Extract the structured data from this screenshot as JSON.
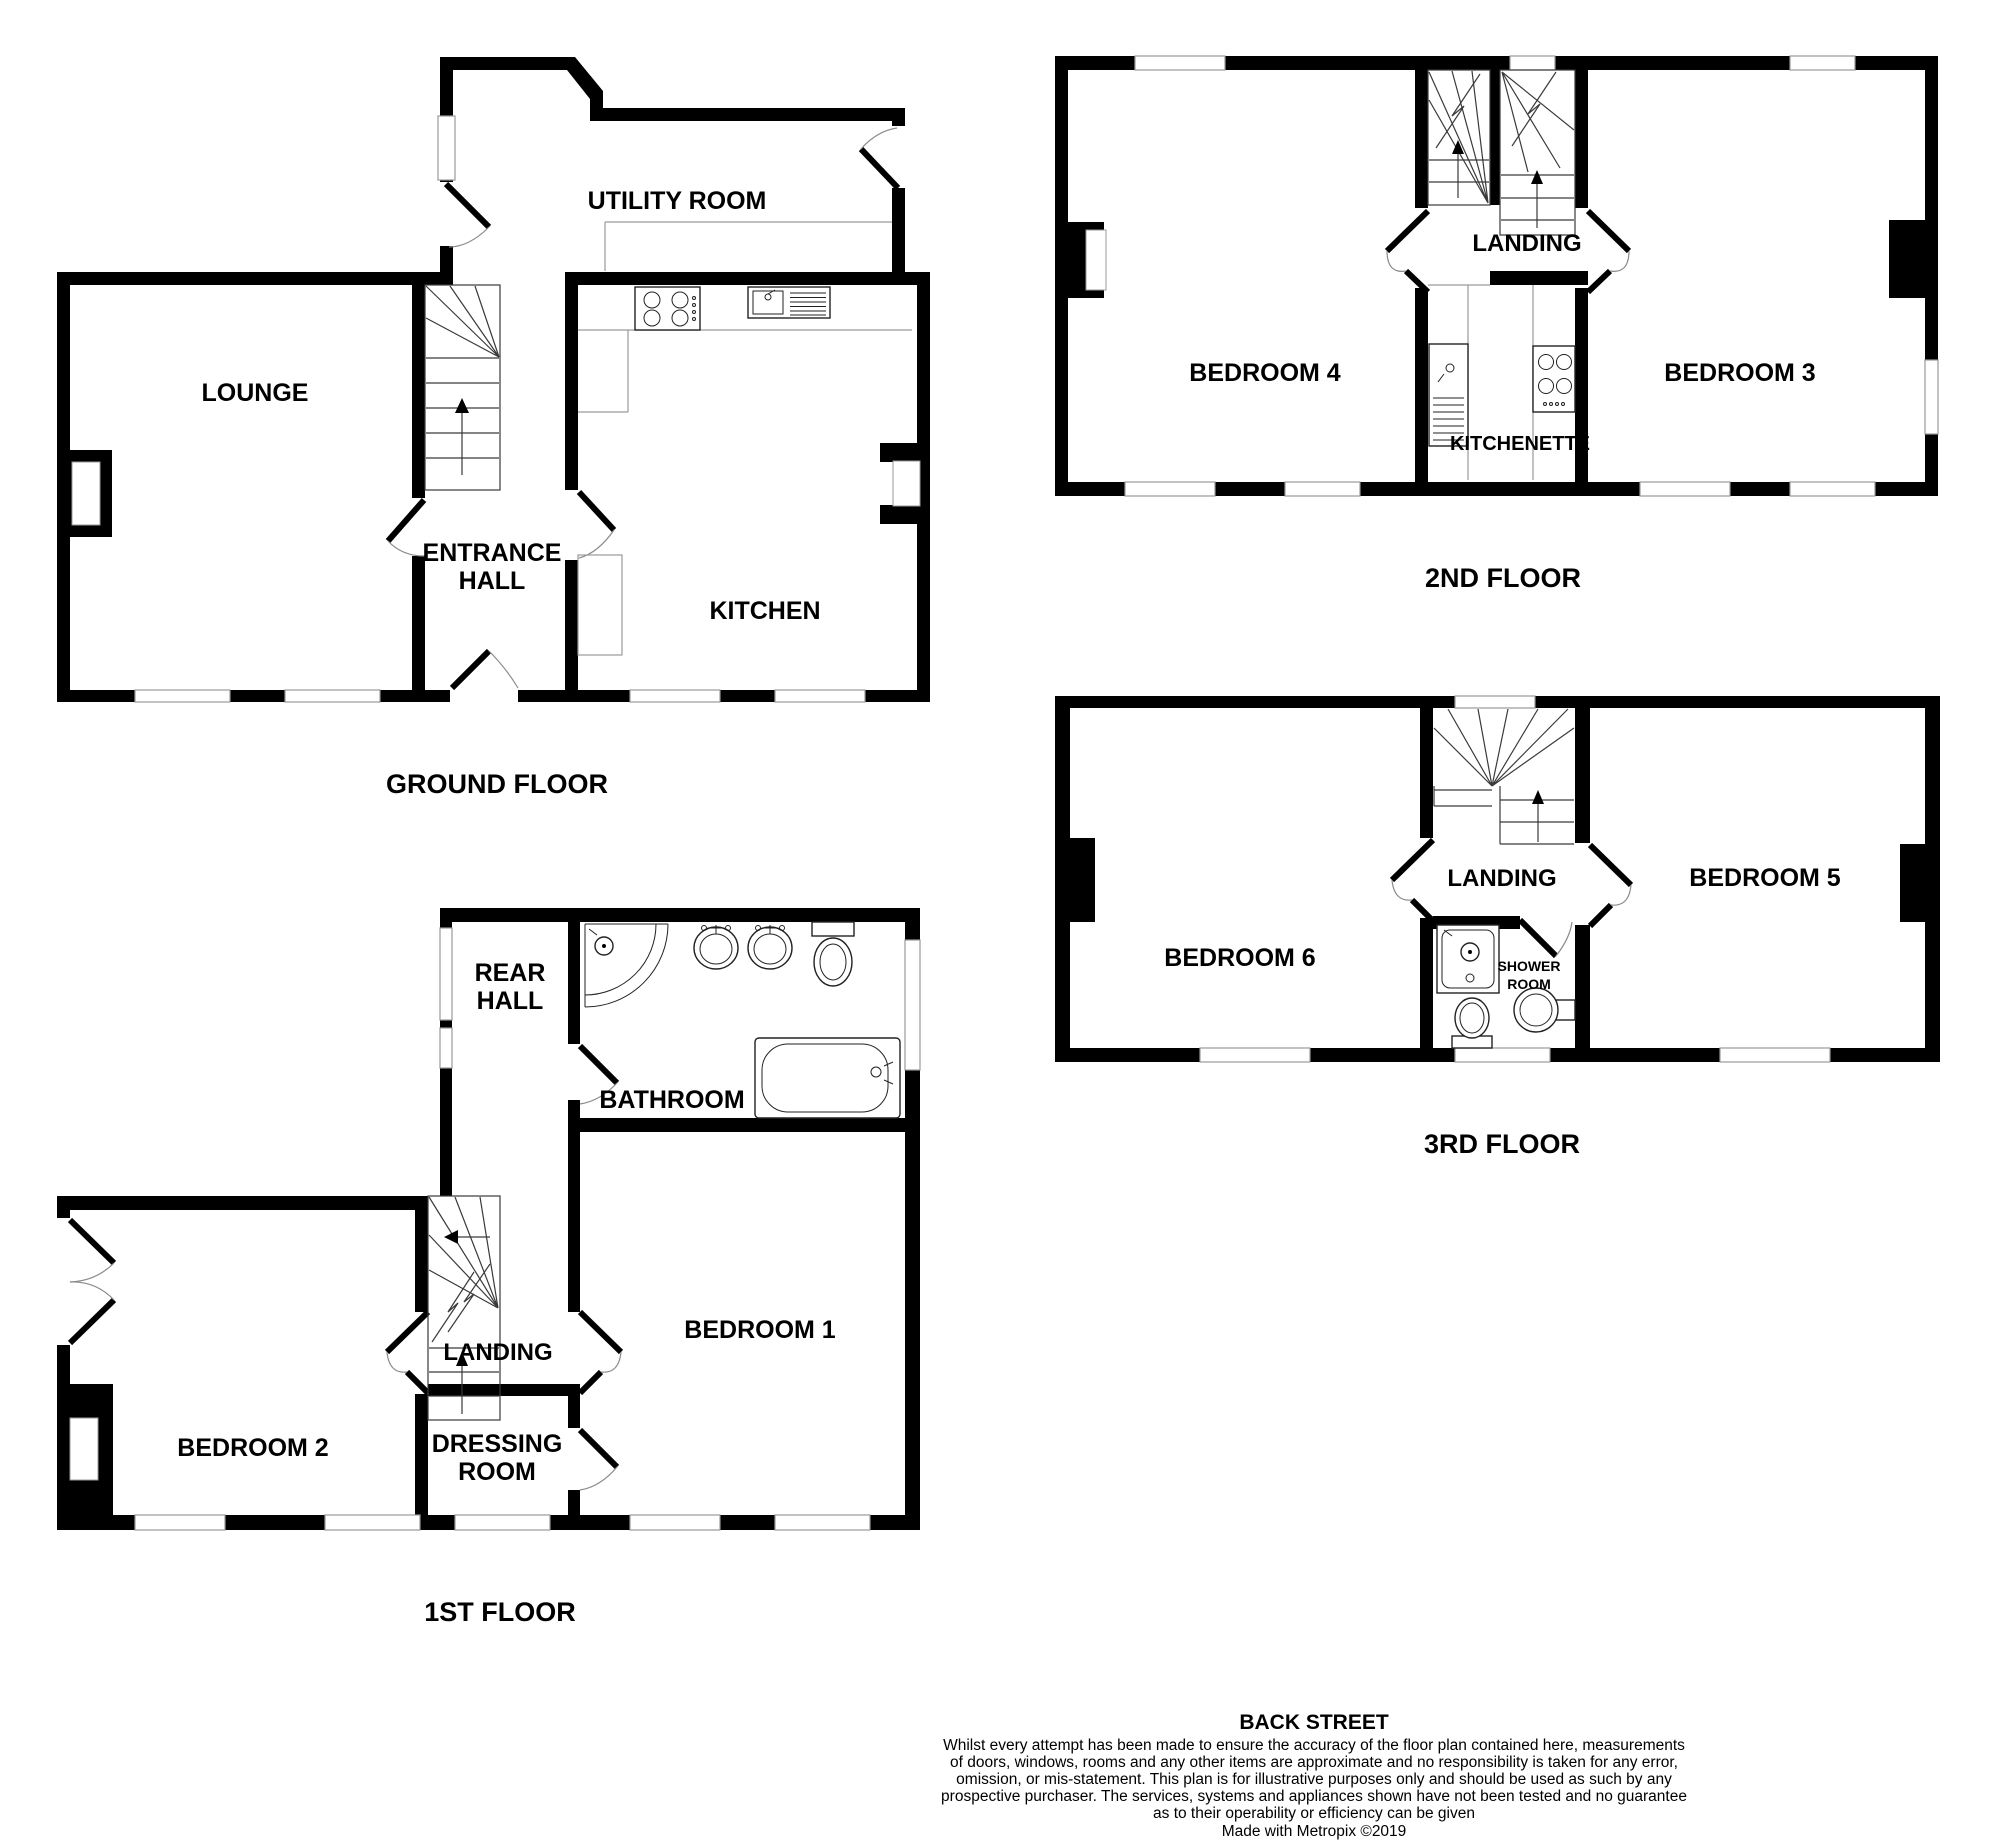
{
  "title": "BACK STREET",
  "colors": {
    "walls": "#000000",
    "thin_lines": "#9a9a9a",
    "stair_lines": "#3a3a3a",
    "background": "#ffffff",
    "text": "#000000"
  },
  "floors": {
    "ground": {
      "label": "GROUND FLOOR",
      "rooms": {
        "lounge": "LOUNGE",
        "entrance": [
          "ENTRANCE",
          "HALL"
        ],
        "kitchen": "KITCHEN",
        "utility": "UTILITY ROOM"
      }
    },
    "first": {
      "label": "1ST FLOOR",
      "rooms": {
        "rear_hall": [
          "REAR",
          "HALL"
        ],
        "bathroom": "BATHROOM",
        "bedroom2": "BEDROOM 2",
        "landing": "LANDING",
        "bedroom1": "BEDROOM 1",
        "dressing": [
          "DRESSING",
          "ROOM"
        ]
      }
    },
    "second": {
      "label": "2ND FLOOR",
      "rooms": {
        "bedroom4": "BEDROOM 4",
        "landing": "LANDING",
        "kitchenette": "KITCHENETTE",
        "bedroom3": "BEDROOM 3"
      }
    },
    "third": {
      "label": "3RD FLOOR",
      "rooms": {
        "bedroom6": "BEDROOM 6",
        "landing": "LANDING",
        "shower": [
          "SHOWER",
          "ROOM"
        ],
        "bedroom5": "BEDROOM 5"
      }
    }
  },
  "footer": {
    "street": "BACK STREET",
    "disclaimer": [
      "Whilst every attempt has been made to ensure the accuracy of the floor plan contained here, measurements",
      "of doors, windows, rooms and any other items are approximate and no responsibility is taken for any error,",
      "omission, or mis-statement. This plan is for illustrative purposes only and should be used as such by any",
      "prospective purchaser. The services, systems and appliances shown have not been tested and no guarantee",
      "as to their operability or efficiency can be given"
    ],
    "credit": "Made with Metropix ©2019"
  }
}
